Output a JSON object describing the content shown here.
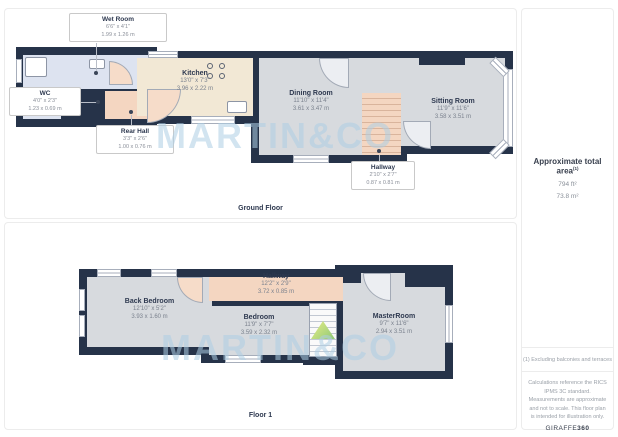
{
  "watermark": {
    "text": "MARTIN&CO"
  },
  "ground_floor": {
    "label": "Ground Floor",
    "rooms": {
      "wet_room": {
        "name": "Wet Room",
        "imperial": "6'6\" x 4'1\"",
        "metric": "1.99 x 1.26 m"
      },
      "wc": {
        "name": "WC",
        "imperial": "4'0\" x 2'3\"",
        "metric": "1.23 x 0.69 m"
      },
      "rear_hall": {
        "name": "Rear Hall",
        "imperial": "3'3\" x 2'6\"",
        "metric": "1.00 x 0.76 m"
      },
      "kitchen": {
        "name": "Kitchen",
        "imperial": "13'0\" x 7'3\"",
        "metric": "3.96 x 2.22 m"
      },
      "dining_room": {
        "name": "Dining Room",
        "imperial": "11'10\" x 11'4\"",
        "metric": "3.61 x 3.47 m"
      },
      "hallway": {
        "name": "Hallway",
        "imperial": "2'10\" x 2'7\"",
        "metric": "0.87 x 0.81 m"
      },
      "sitting_room": {
        "name": "Sitting Room",
        "imperial": "11'9\" x 11'6\"",
        "metric": "3.58 x 3.51 m"
      }
    }
  },
  "first_floor": {
    "label": "Floor 1",
    "rooms": {
      "back_bedroom": {
        "name": "Back Bedroom",
        "imperial": "12'10\" x 5'2\"",
        "metric": "3.93 x 1.60 m"
      },
      "hallway": {
        "name": "Hallway",
        "imperial": "12'2\" x 2'9\"",
        "metric": "3.72 x 0.85 m"
      },
      "bedroom": {
        "name": "Bedroom",
        "imperial": "11'9\" x 7'7\"",
        "metric": "3.59 x 2.32 m"
      },
      "master_room": {
        "name": "MasterRoom",
        "imperial": "9'7\" x 11'6\"",
        "metric": "2.94 x 3.51 m"
      }
    }
  },
  "sidebar": {
    "total_area_label": "Approximate total area",
    "total_area_superscript": "(1)",
    "area_ft": "794 ft²",
    "area_m": "73.8 m²",
    "footnote": "(1) Excluding balconies and terraces",
    "disclaimer": "Calculations reference the RICS IPMS 3C standard. Measurements are approximate and not to scale. This floor plan is intended for illustration only.",
    "brand_name": "GIRAFFE",
    "brand_suffix": "360"
  },
  "colors": {
    "wall": "#263349",
    "room_gray": "#d7dade",
    "kitchen_cream": "#f2e8d5",
    "wet_room_blue": "#dde3f0",
    "hallway_peach": "#f4d6c1",
    "watermark_blue": "#aecfe5"
  }
}
